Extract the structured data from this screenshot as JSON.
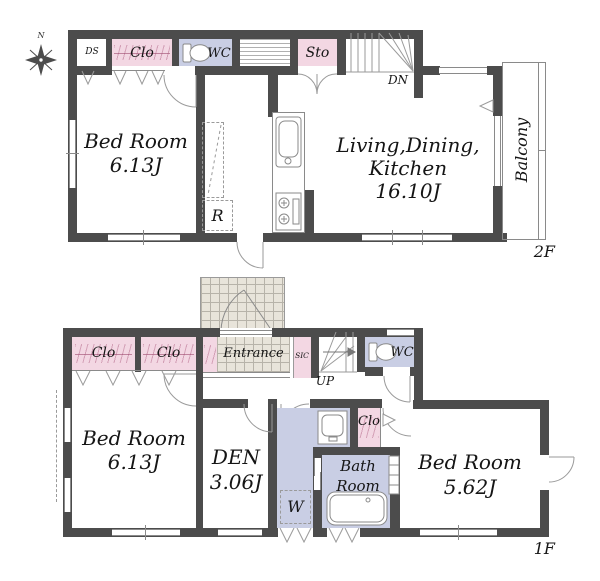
{
  "compass": {
    "north": "N"
  },
  "colors": {
    "wall": "#4c4c4c",
    "closet_pink": "#f3d7e3",
    "wet_blue": "#c9cee4",
    "tile_beige": "#e8e4da"
  },
  "floors": {
    "f2": {
      "tag": "2F",
      "ds": "DS",
      "clo": "Clo",
      "wc": "WC",
      "sto": "Sto",
      "dn": "DN",
      "fridge": "R",
      "bedroom": {
        "name": "Bed Room",
        "size": "6.13J"
      },
      "ldk": {
        "l1": "Living,Dining,",
        "l2": "Kitchen",
        "l3": "16.10J"
      },
      "balcony": "Balcony"
    },
    "f1": {
      "tag": "1F",
      "clo_a": "Clo",
      "clo_b": "Clo",
      "entrance": "Entrance",
      "sic": "SIC",
      "up": "UP",
      "wc": "WC",
      "bedroom_w": {
        "name": "Bed Room",
        "size": "6.13J"
      },
      "den": {
        "name": "DEN",
        "size": "3.06J"
      },
      "washer": "W",
      "clo_c": "Clo",
      "bath": {
        "l1": "Bath",
        "l2": "Room"
      },
      "bedroom_e": {
        "name": "Bed Room",
        "size": "5.62J"
      }
    }
  }
}
